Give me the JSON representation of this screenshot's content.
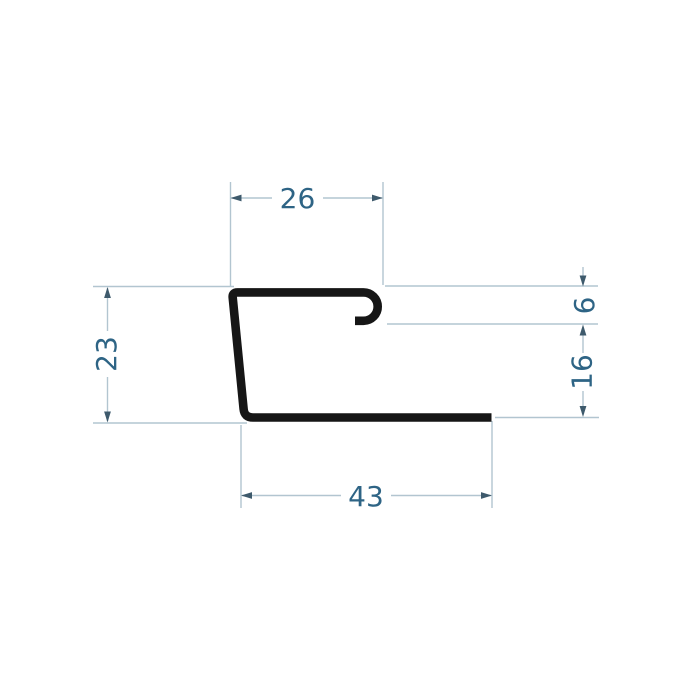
{
  "drawing": {
    "name": "profile-cross-section",
    "dimensions": {
      "top_width": "26",
      "left_height": "23",
      "hook_depth": "6",
      "right_height": "16",
      "bottom_width": "43"
    },
    "colors": {
      "profile": "#161616",
      "dim_line": "#b2c5d0",
      "dim_text": "#2e6485",
      "arrow": "#3e5a6c",
      "background": "#ffffff"
    }
  }
}
